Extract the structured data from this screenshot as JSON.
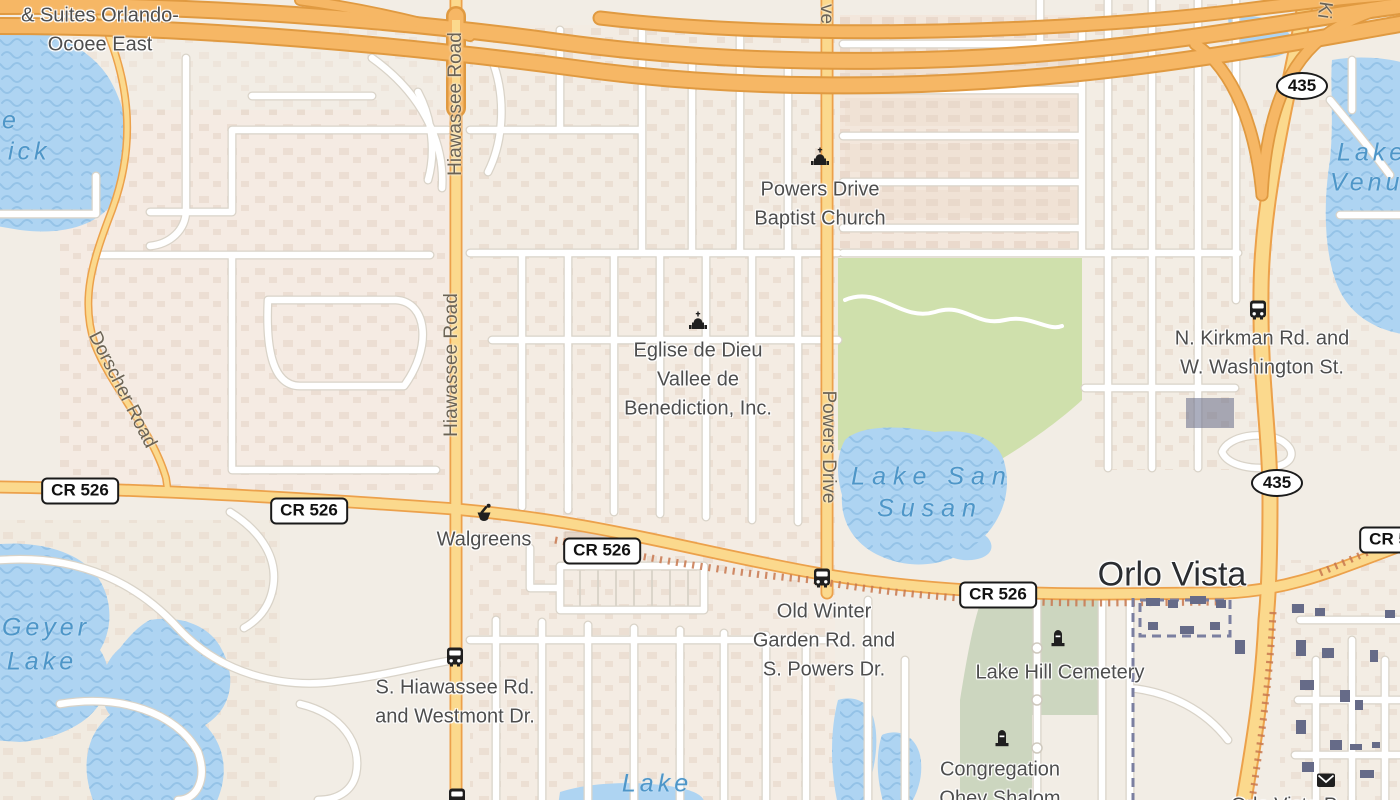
{
  "map": {
    "city_labels": [
      {
        "text": "Orlo Vista",
        "x": 1172,
        "y": 575
      }
    ],
    "road_shields": [
      {
        "shape": "rect",
        "label": "CR 526",
        "x": 80,
        "y": 491
      },
      {
        "shape": "rect",
        "label": "CR 526",
        "x": 309,
        "y": 511
      },
      {
        "shape": "rect",
        "label": "CR 526",
        "x": 602,
        "y": 551
      },
      {
        "shape": "rect",
        "label": "CR 526",
        "x": 998,
        "y": 595
      },
      {
        "shape": "rect",
        "label": "CR 526",
        "x": 1398,
        "y": 540
      },
      {
        "shape": "oval",
        "label": "435",
        "x": 1302,
        "y": 86
      },
      {
        "shape": "oval",
        "label": "435",
        "x": 1277,
        "y": 483
      }
    ],
    "street_labels": [
      {
        "text": "Hiawassee Road",
        "x": 456,
        "y": 104,
        "angle": -90
      },
      {
        "text": "Hiawassee Road",
        "x": 452,
        "y": 365,
        "angle": -90
      },
      {
        "text": "Powers Drive",
        "x": 828,
        "y": 447,
        "angle": 90
      },
      {
        "text": "Dorscher Road",
        "x": 122,
        "y": 390,
        "angle": 63
      },
      {
        "text": "ve",
        "x": 826,
        "y": 14,
        "angle": 90
      },
      {
        "text": "Ki",
        "x": 1324,
        "y": 10,
        "angle": 98
      }
    ],
    "water_labels": [
      {
        "text": "e",
        "x": 2,
        "y": 121,
        "anchor": "left"
      },
      {
        "text": "ick",
        "x": 8,
        "y": 152,
        "anchor": "left"
      },
      {
        "text": "Geyer",
        "x": 46,
        "y": 628
      },
      {
        "text": "Lake",
        "x": 42,
        "y": 662
      },
      {
        "text": "Lake San",
        "x": 932,
        "y": 477,
        "spacing": "7px"
      },
      {
        "text": "Susan",
        "x": 930,
        "y": 509,
        "spacing": "7px"
      },
      {
        "text": "Lake",
        "x": 1337,
        "y": 153,
        "anchor": "left"
      },
      {
        "text": "Venus",
        "x": 1330,
        "y": 183,
        "anchor": "left"
      },
      {
        "text": "Lake",
        "x": 657,
        "y": 784
      }
    ],
    "poi_labels": [
      {
        "lines": [
          "Holiday Inn Express",
          "& Suites Orlando-",
          "Ocoee East"
        ],
        "x": 100,
        "y": -13,
        "note": "first line clipped by top edge"
      },
      {
        "lines": [
          "Powers Drive",
          "Baptist Church"
        ],
        "x": 820,
        "y": 190
      },
      {
        "lines": [
          "Eglise de Dieu",
          "Vallee de",
          "Benediction, Inc."
        ],
        "x": 698,
        "y": 351
      },
      {
        "lines": [
          "Walgreens"
        ],
        "x": 484,
        "y": 540
      },
      {
        "lines": [
          "Old Winter",
          "Garden Rd. and",
          "S. Powers Dr."
        ],
        "x": 824,
        "y": 612
      },
      {
        "lines": [
          "S. Hiawassee Rd.",
          "and Westmont Dr."
        ],
        "x": 455,
        "y": 688
      },
      {
        "lines": [
          "N. Kirkman Rd. and",
          "W. Washington St."
        ],
        "x": 1262,
        "y": 339
      },
      {
        "lines": [
          "Lake Hill Cemetery"
        ],
        "x": 1060,
        "y": 673
      },
      {
        "lines": [
          "Congregation",
          "Ohev Shalom"
        ],
        "x": 1000,
        "y": 770
      },
      {
        "lines": [
          "Orlo Vista P"
        ],
        "x": 1284,
        "y": 806,
        "note": "clipped by bottom edge"
      }
    ],
    "poi_icons": [
      {
        "icon": "church-icon",
        "x": 820,
        "y": 158
      },
      {
        "icon": "church-icon",
        "x": 698,
        "y": 322
      },
      {
        "icon": "pharmacy-icon",
        "x": 484,
        "y": 513
      },
      {
        "icon": "bus-icon",
        "x": 822,
        "y": 578
      },
      {
        "icon": "bus-icon",
        "x": 455,
        "y": 657
      },
      {
        "icon": "bus-icon",
        "x": 1258,
        "y": 310
      },
      {
        "icon": "bus-icon",
        "x": 457,
        "y": 798
      },
      {
        "icon": "grave-icon",
        "x": 1058,
        "y": 640
      },
      {
        "icon": "grave-icon",
        "x": 1002,
        "y": 740
      },
      {
        "icon": "mail-icon",
        "x": 1326,
        "y": 780
      }
    ],
    "colors": {
      "base": "#f2ede5",
      "water": "#aed4f2",
      "park": "#cfe0ac",
      "cemetery": "#ccd6bf",
      "highway": "#f6b765",
      "primary_road": "#fbd98d",
      "primary_casing": "#eca14b",
      "local_road": "#ffffff",
      "poi_text": "#4e4e4e",
      "water_text": "#4e96c8",
      "street_text": "#6b6355",
      "city_text": "#2b2d31"
    }
  }
}
